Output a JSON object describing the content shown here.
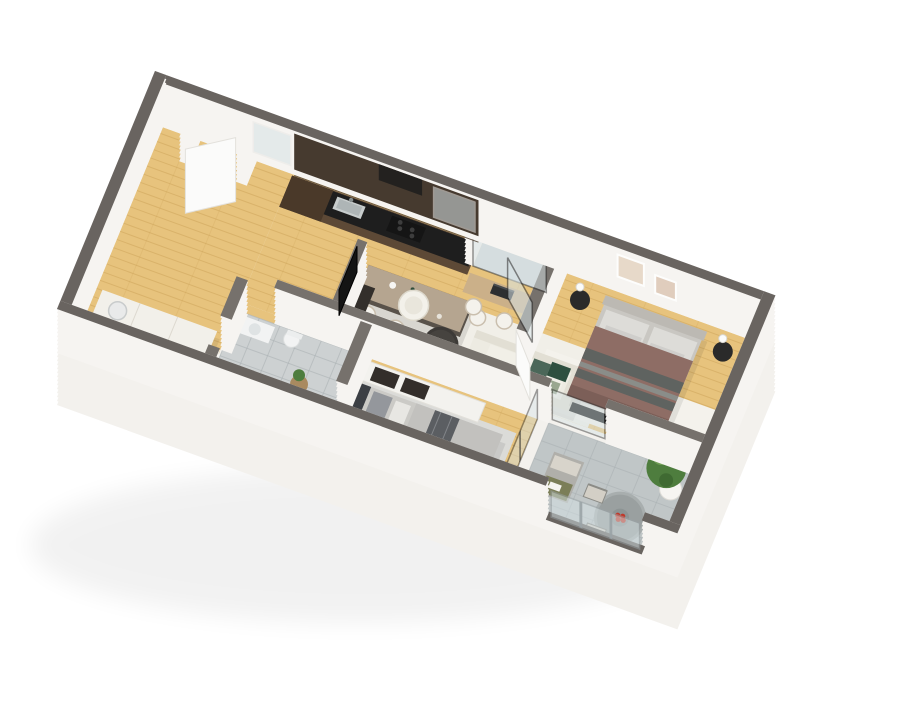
{
  "scene": {
    "description": "3D isometric cutaway floor plan rendering of a two-bedroom apartment with open kitchen and living room, master bedroom, second bedroom, bathroom, entry hall and wrap-around balcony, viewed from above on a white background",
    "background": "#ffffff"
  },
  "rooms": [
    {
      "name": "entry-hall",
      "floor": "wood"
    },
    {
      "name": "kitchen-living-room",
      "floor": "wood"
    },
    {
      "name": "master-bedroom",
      "floor": "wood"
    },
    {
      "name": "second-bedroom",
      "floor": "wood"
    },
    {
      "name": "bathroom",
      "floor": "tile"
    },
    {
      "name": "loggia",
      "floor": "tile"
    },
    {
      "name": "balcony",
      "floor": "tile"
    }
  ],
  "furniture": [
    "entry-door",
    "hall-closet",
    "kitchen-counter",
    "kitchen-tall-cabinet",
    "kitchen-sink",
    "kitchen-cooktop",
    "kitchen-island",
    "bar-stool",
    "desk",
    "laptop",
    "sofa",
    "green-pillow",
    "sage-pillow",
    "coffee-table",
    "armchair",
    "tv",
    "tv-console",
    "living-rug",
    "master-bed",
    "nightstand",
    "table-lamp",
    "wall-art",
    "bed-bench",
    "master-rug",
    "pouf",
    "bathtub",
    "vanity-sink",
    "toilet",
    "plant-table",
    "wardrobe",
    "second-bed",
    "bedroom2-rug",
    "glass-partition",
    "sliding-glass-door",
    "window",
    "lounge-chair",
    "outdoor-table",
    "outdoor-chair",
    "fruit-plate",
    "potted-plant",
    "glass-balustrade"
  ],
  "colors": {
    "background": "#ffffff",
    "base": "#f3f1ed",
    "wallSide": "#f6f4f1",
    "wallTop": "#696460",
    "wallTopInner": "#76716c",
    "floorWood": "#e7c37d",
    "plankLine": "#c99f55",
    "tileBath": "#cdd1d2",
    "tileBalcony": "#c0c6c7",
    "tileLoggia": "#d4d9da",
    "grout": "#a9b0b2",
    "rugLiving": "#f1efe8",
    "rugBed1": "#f4f2ec",
    "rugBed2": "#dbdbd8",
    "kitchenCabinet": "#5d4936",
    "kitchenTall": "#4a3929",
    "kitchenCounter": "#1e1e1e",
    "kitchenUpper": "#463a2f",
    "hoodDark": "#23211f",
    "islandBase": "#59524a",
    "islandTop": "#b5a590",
    "deskWood": "#cbb089",
    "stoolSeat": "#f4f2ec",
    "stoolEdge": "#cabfae",
    "sofaBody": "#edebe2",
    "sofaBack": "#e2dfd4",
    "sofaCushion": "#f1efe7",
    "pillowGreen": "#2e4f3f",
    "pillowSage": "#9aa78f",
    "throwCream": "#f7f5ef",
    "armchair": "#f3f1ea",
    "armchairSeat": "#e9e6dc",
    "coffeeTable": "#3d3a37",
    "fruitOrange": "#d88a2f",
    "tv": "#141414",
    "console": "#332f2b",
    "bedFrame": "#c9c7c2",
    "headboard1": "#bcb9b3",
    "bedPillow": "#dddcd8",
    "blanketMauve": "#8e6d65",
    "blanketStripeDark": "#5f6360",
    "blanketStripeLight": "#8a8d89",
    "blanketFold": "#7c5f58",
    "benchBlack": "#191919",
    "nightstand": "#2a2a2a",
    "lampWhite": "#fbfbf9",
    "poufGray": "#808286",
    "bed2Mattress": "#cbcac6",
    "bed2Blanket": "#c2c1be",
    "bed2StripeDark": "#5b5e62",
    "bed2PillowDark": "#94979c",
    "bed2PillowLight": "#e8e7e3",
    "headboard2": "#3c3f44",
    "poufWhite": "#edece7",
    "poufDark": "#57595d",
    "wardrobeWhite": "#f3f2ee",
    "wardrobeDark": "#332e2a",
    "tubWhite": "#f7f8f8",
    "tubInner": "#e7ebec",
    "fixtureWhite": "#f2f3f3",
    "tableWoodSmall": "#a98a60",
    "plantGreen": "#4e7d3e",
    "plantLight": "#6f9c55",
    "plantPot": "#f6f5f2",
    "loungeChair": "#b0afaa",
    "loungeCushion": "#d8d4cb",
    "throwOlive": "#7b7e58",
    "outdoorTable": "#9aa0a0",
    "outdoorTableRim": "#a8aeae",
    "plateDark": "#8d9494",
    "outdoorChair": "#d3cfc6",
    "chairFrame": "#8b8b86",
    "fruitRed": "#c0392b",
    "glass": "#d6e2e5",
    "glassFrame": "#2b2b2b",
    "balustradeFrame": "#9aa3a6",
    "doorWhite": "#fbfbfa",
    "doorEdge": "#e3e1dc",
    "artA": "#e7d9c9",
    "artB": "#e0cdbd",
    "closetWhite": "#f2f0ea",
    "closetLine": "#ddd9d0",
    "washer": "#e9eaea",
    "shadow": "#000000"
  }
}
